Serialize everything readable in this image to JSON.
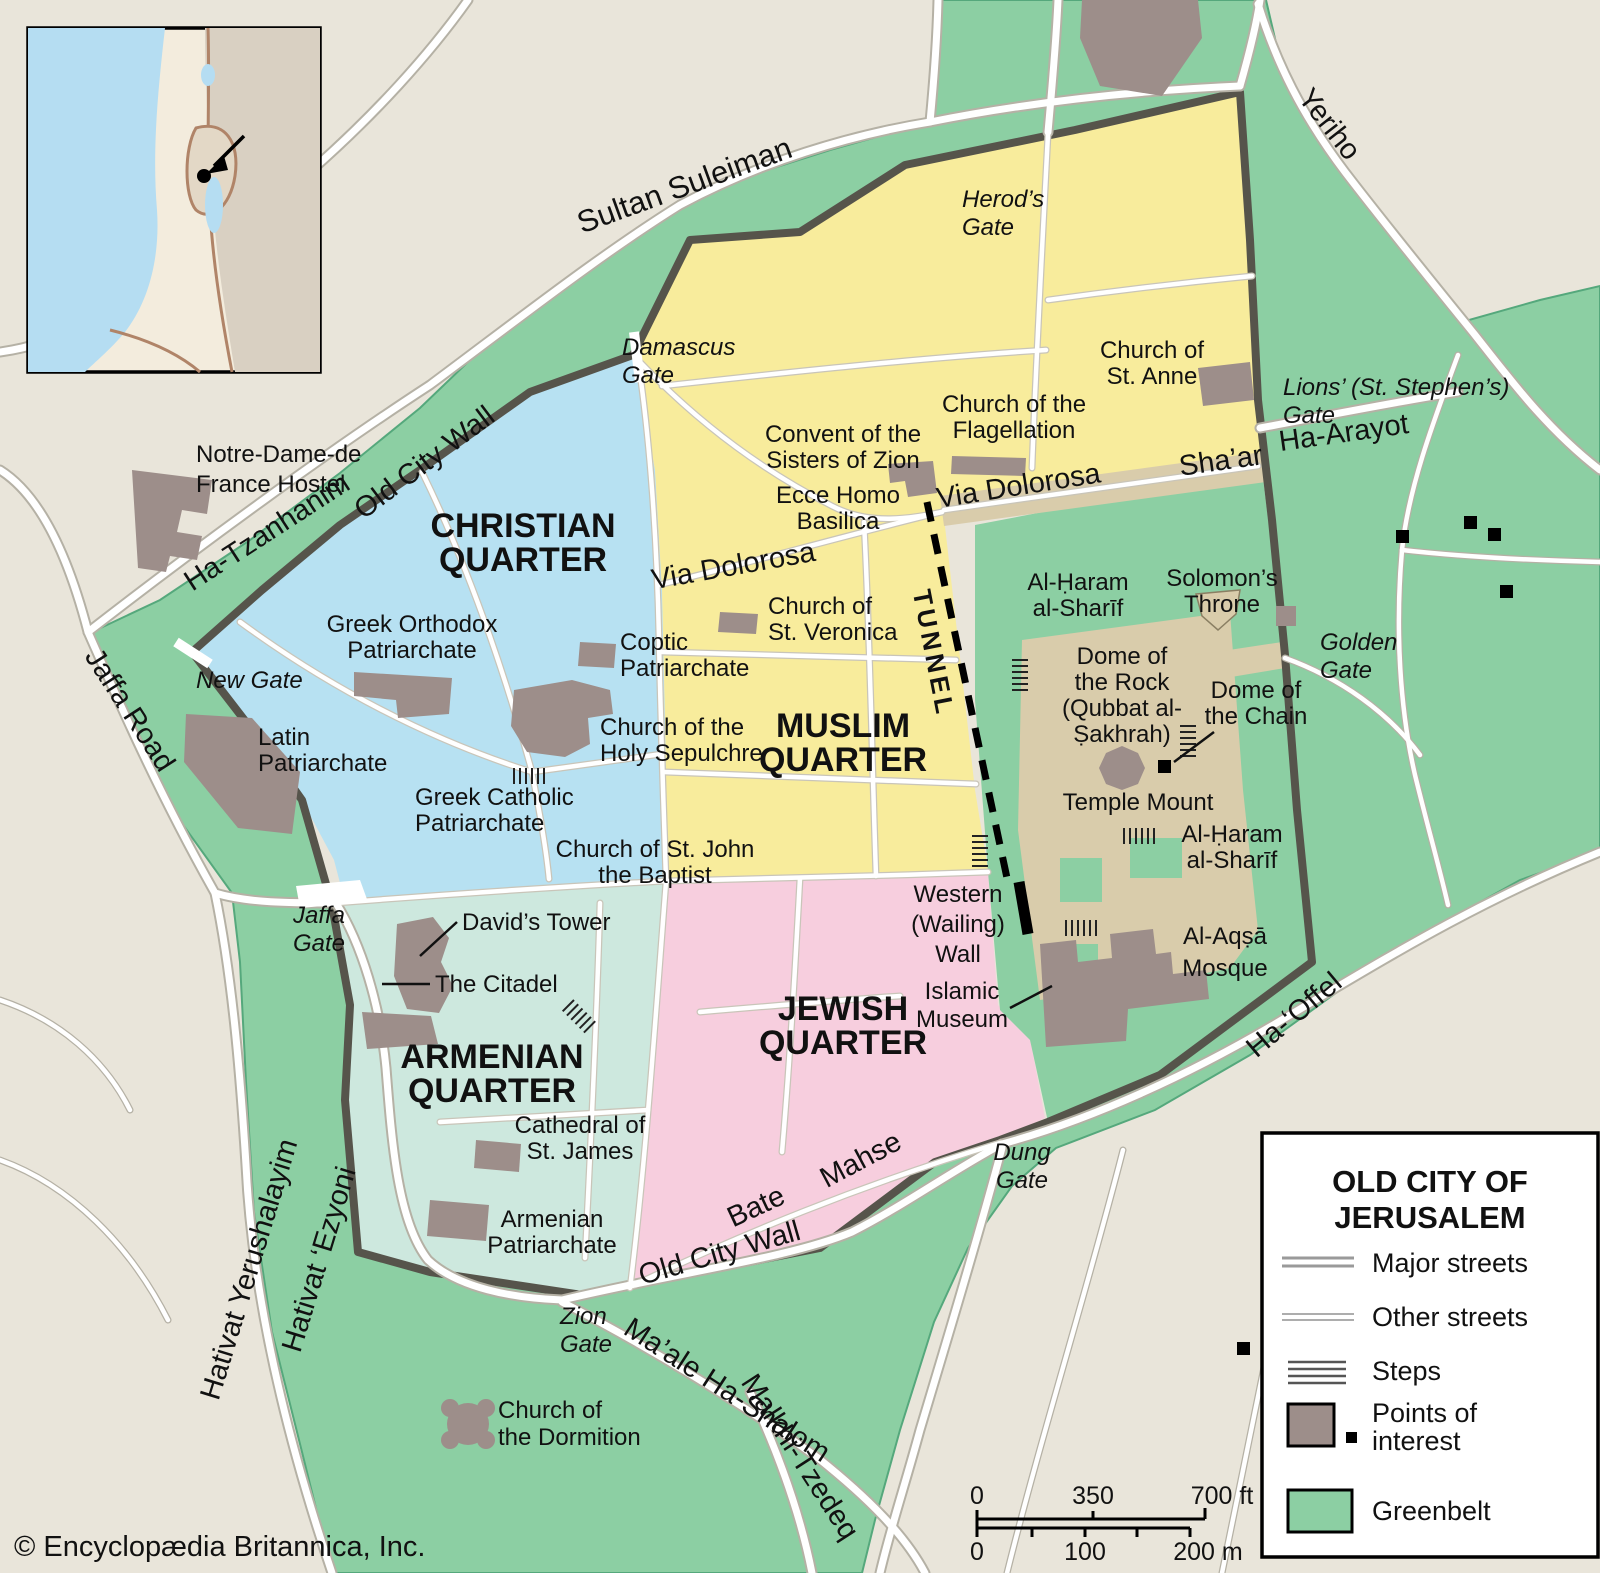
{
  "palette": {
    "background": "#e9e5da",
    "greenbelt": "#8ccfa3",
    "green_edge": "#55a87c",
    "christian": "#b7e1f2",
    "muslim": "#f8ec9c",
    "armenian": "#cde8de",
    "jewish": "#f7cede",
    "platform": "#d9ccab",
    "building": "#9d8e8a",
    "wall": "#56544b",
    "road_casing": "#b5b1a5",
    "street_casing": "#c9c5b9",
    "water": "#b5ddf2",
    "inset_land": "#f3ecdd",
    "inset_far": "#d9d0c2",
    "inset_border": "#b08468",
    "text": "#111111"
  },
  "quarters": {
    "christian": [
      "CHRISTIAN",
      "QUARTER"
    ],
    "muslim": [
      "MUSLIM",
      "QUARTER"
    ],
    "armenian": [
      "ARMENIAN",
      "QUARTER"
    ],
    "jewish": [
      "JEWISH",
      "QUARTER"
    ]
  },
  "roads": {
    "sultan_suleiman": "Sultan Suleiman",
    "yeriho": "Yeriho",
    "old_city_wall_nw": "Old City Wall",
    "old_city_wall_s": "Old City Wall",
    "ha_tzanhanim": "Ha-Tzanhanim",
    "jaffa_road": "Jaffa Road",
    "shaar": "Sha’ar",
    "ha_arayot": "Ha-Arayot",
    "via_dolorosa_e": "Via Dolorosa",
    "via_dolorosa_w": "Via Dolorosa",
    "tunnel": "TUNNEL",
    "ha_offel": "Ha-‘Offel",
    "hativat_yerushalayim": "Hativat Yerushalayim",
    "hativat_ezyoni": "Hativat ‘Ezyoni",
    "bate": "Bate",
    "mahse": "Mahse",
    "maale_hashalom": "Ma’ale Ha-Shalom",
    "malkhi_tzedeq": "Malkhi-Tzedeq"
  },
  "gates": {
    "damascus": [
      "Damascus",
      "Gate"
    ],
    "herods": [
      "Herod’s",
      "Gate"
    ],
    "lions": [
      "Lions’ (St. Stephen’s)",
      "Gate"
    ],
    "golden": [
      "Golden",
      "Gate"
    ],
    "new_gate": "New Gate",
    "jaffa": [
      "Jaffa",
      "Gate"
    ],
    "zion": [
      "Zion",
      "Gate"
    ],
    "dung": [
      "Dung",
      "Gate"
    ]
  },
  "pois": {
    "notre_dame": [
      "Notre-Dame-de",
      "France Hostel"
    ],
    "st_anne": [
      "Church of",
      "St. Anne"
    ],
    "sisters_zion": [
      "Convent of the",
      "Sisters of Zion"
    ],
    "flagellation": [
      "Church of the",
      "Flagellation"
    ],
    "ecce_homo": [
      "Ecce Homo",
      "Basilica"
    ],
    "greek_orthodox": [
      "Greek Orthodox",
      "Patriarchate"
    ],
    "coptic": [
      "Coptic",
      "Patriarchate"
    ],
    "st_veronica": [
      "Church of",
      "St. Veronica"
    ],
    "holy_sepulchre": [
      "Church of the",
      "Holy Sepulchre"
    ],
    "latin": [
      "Latin",
      "Patriarchate"
    ],
    "greek_catholic": [
      "Greek Catholic",
      "Patriarchate"
    ],
    "st_john": [
      "Church of St. John",
      "the Baptist"
    ],
    "davids_tower": "David’s Tower",
    "citadel": "The Citadel",
    "western_wall": [
      "Western",
      "(Wailing)",
      "Wall"
    ],
    "islamic_museum": [
      "Islamic",
      "Museum"
    ],
    "al_aqsa": [
      "Al-Aqṣā",
      "Mosque"
    ],
    "haram_n": [
      "Al-Ḥaram",
      "al-Sharīf"
    ],
    "haram_s": [
      "Al-Ḥaram",
      "al-Sharīf"
    ],
    "solomons_throne": [
      "Solomon’s",
      "Throne"
    ],
    "dome_rock": [
      "Dome of",
      "the Rock",
      "(Qubbat al-",
      "Ṣakhrah)"
    ],
    "dome_chain": [
      "Dome of",
      "the Chain"
    ],
    "temple_mount": "Temple Mount",
    "st_james": [
      "Cathedral of",
      "St. James"
    ],
    "armenian_patriarchate": [
      "Armenian",
      "Patriarchate"
    ],
    "dormition": [
      "Church of",
      "the Dormition"
    ]
  },
  "legend": {
    "title1": "OLD CITY OF",
    "title2": "JERUSALEM",
    "major": "Major streets",
    "other": "Other streets",
    "steps": "Steps",
    "poi1": "Points of",
    "poi2": "interest",
    "greenbelt": "Greenbelt"
  },
  "scalebar": {
    "ft0": "0",
    "ft350": "350",
    "ft700": "700 ft",
    "m0": "0",
    "m100": "100",
    "m200": "200 m"
  },
  "copyright": "© Encyclopædia Britannica, Inc."
}
